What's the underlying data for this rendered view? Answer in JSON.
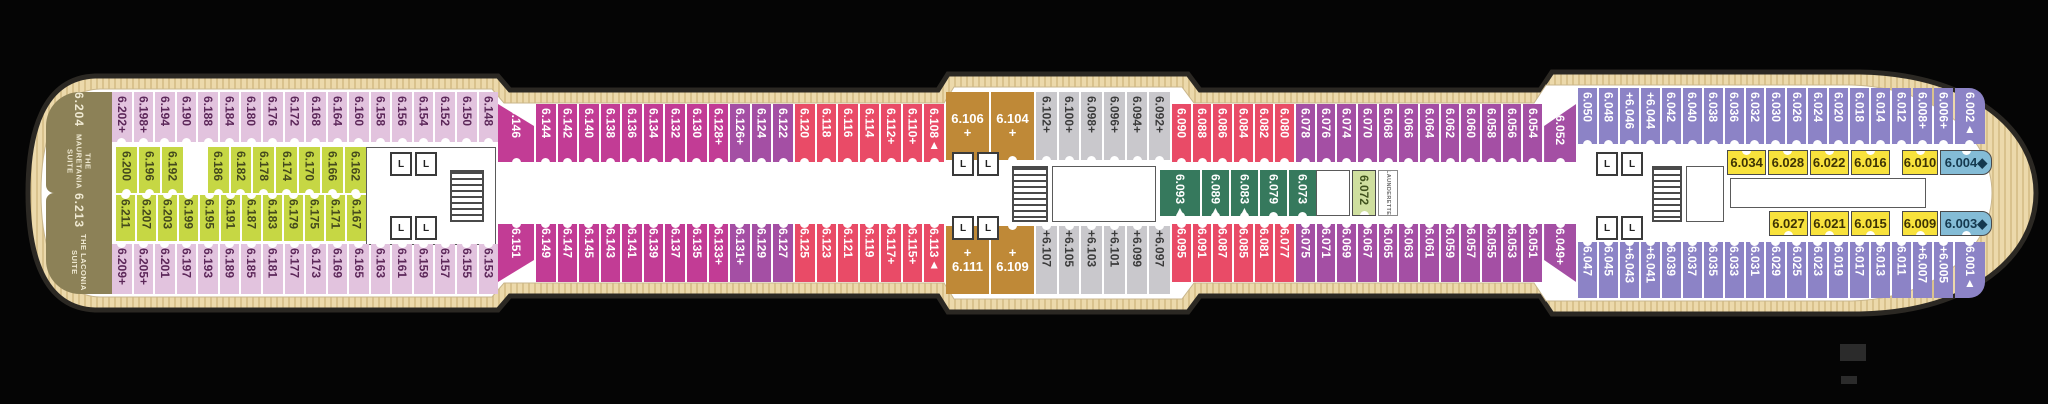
{
  "deck_plan": {
    "background": "#050505",
    "palette": {
      "lilac": "#e2c3de",
      "lime": "#c6d744",
      "magenta": "#c23c95",
      "purple": "#a44fa4",
      "red": "#e94b67",
      "gray": "#c9c8cc",
      "brown": "#bf8937",
      "teal": "#36795d",
      "palegreen": "#cfdf9f",
      "periwinkle": "#8c83c6",
      "yellow": "#f8e23c",
      "blue": "#84bcd6",
      "suite_olive": "#8c8157",
      "deck_wood": "#ecd9ab",
      "deck_stripe": "#d9c28d",
      "hull_outline": "#2b2823",
      "corridor": "#ffffff"
    },
    "symbols": {
      "plus": "+",
      "triangle": "▲",
      "diamond": "◆"
    },
    "suites": [
      {
        "number": "6.204",
        "name": "THE MAURETANIA SUITE",
        "x": 46,
        "y": 92,
        "w": 66,
        "h": 101,
        "radius": "34px 0 0 8px"
      },
      {
        "number": "6.213",
        "name": "THE LACONIA SUITE",
        "x": 46,
        "y": 193,
        "w": 66,
        "h": 101,
        "radius": "8px 0 0 34px"
      }
    ],
    "rows": [
      {
        "id": "aft-top-outer",
        "x": 112,
        "y": 92,
        "w": 386,
        "h": 50,
        "orient": "v",
        "color": "lilac",
        "notch": "b",
        "cells": [
          "6.202+",
          "6.198+",
          "6.194",
          "6.190",
          "6.188",
          "6.184",
          "6.180",
          "6.176",
          "6.172",
          "6.168",
          "6.164",
          "6.160",
          "6.158",
          "6.156",
          "6.154",
          "6.152",
          "6.150",
          "6.148"
        ]
      },
      {
        "id": "aft-top-inner",
        "x": 116,
        "y": 147,
        "w": 250,
        "h": 46,
        "orient": "v",
        "color": "lime",
        "notch": "b",
        "cells": [
          "6.200",
          "6.196",
          "6.192",
          null,
          "6.186",
          "6.182",
          "6.178",
          "6.174",
          "6.170",
          "6.166",
          "6.162"
        ]
      },
      {
        "id": "aft-bottom-inner",
        "x": 116,
        "y": 195,
        "w": 250,
        "h": 46,
        "orient": "v",
        "color": "lime",
        "notch": "t",
        "cells": [
          "6.211",
          "6.207",
          "6.203",
          "6.199",
          "6.195",
          "6.191",
          "6.187",
          "6.183",
          "6.179",
          "6.175",
          "6.171",
          "6.167"
        ]
      },
      {
        "id": "aft-bottom-outer",
        "x": 112,
        "y": 244,
        "w": 386,
        "h": 50,
        "orient": "v",
        "color": "lilac",
        "notch": "t",
        "cells": [
          "6.209+",
          "6.205+",
          "6.201",
          "6.197",
          "6.193",
          "6.189",
          "6.185",
          "6.181",
          "6.177",
          "6.173",
          "6.169",
          "6.165",
          "6.163",
          "6.161",
          "6.159",
          "6.157",
          "6.155",
          "6.153"
        ]
      },
      {
        "id": "waist-top",
        "x": 498,
        "y": 104,
        "w": 446,
        "h": 58,
        "orient": "v",
        "color": "magenta",
        "notch": "b",
        "cells": [
          {
            "label": "6.146",
            "w": 36,
            "shape": "clip-dr"
          },
          "6.144",
          "6.142",
          "6.140",
          "6.138",
          "6.136",
          "6.134",
          "6.132",
          "6.130",
          "6.128+",
          {
            "label": "6.126+",
            "color": "purple"
          },
          {
            "label": "6.124",
            "color": "purple"
          },
          {
            "label": "6.122",
            "color": "purple"
          },
          {
            "label": "6.120",
            "color": "red"
          },
          {
            "label": "6.118",
            "color": "red"
          },
          {
            "label": "6.116",
            "color": "red"
          },
          {
            "label": "6.114",
            "color": "red"
          },
          {
            "label": "6.112+",
            "color": "red"
          },
          {
            "label": "6.110+",
            "color": "red"
          },
          {
            "label": "6.108▲",
            "color": "red"
          }
        ]
      },
      {
        "id": "waist-bottom",
        "x": 498,
        "y": 224,
        "w": 446,
        "h": 58,
        "orient": "v",
        "color": "magenta",
        "notch": "t",
        "cells": [
          {
            "label": "6.151",
            "w": 36,
            "shape": "clip-ur"
          },
          "6.149",
          "6.147",
          "6.145",
          "6.143",
          "6.141",
          "6.139",
          "6.137",
          "6.135",
          "6.133+",
          {
            "label": "6.131+",
            "color": "purple"
          },
          {
            "label": "6.129",
            "color": "purple"
          },
          {
            "label": "6.127",
            "color": "purple"
          },
          {
            "label": "6.125",
            "color": "red"
          },
          {
            "label": "6.123",
            "color": "red"
          },
          {
            "label": "6.121",
            "color": "red"
          },
          {
            "label": "6.119",
            "color": "red"
          },
          {
            "label": "6.117+",
            "color": "red"
          },
          {
            "label": "6.115+",
            "color": "red"
          },
          {
            "label": "6.113▲",
            "color": "red"
          }
        ]
      },
      {
        "id": "mid-top-brown",
        "x": 946,
        "y": 92,
        "w": 88,
        "h": 68,
        "orient": "h",
        "color": "brown",
        "notch": "b",
        "cells": [
          "6.106\n+",
          "6.104\n+"
        ]
      },
      {
        "id": "mid-bottom-brown",
        "x": 946,
        "y": 226,
        "w": 88,
        "h": 68,
        "orient": "h",
        "color": "brown",
        "notch": "t",
        "cells": [
          "+\n6.111",
          "+\n6.109"
        ]
      },
      {
        "id": "mid-top-gray",
        "x": 1036,
        "y": 92,
        "w": 134,
        "h": 68,
        "orient": "v",
        "color": "gray",
        "notch": "b",
        "cells": [
          "6.102+",
          "6.100+",
          "6.098+",
          "6.096+",
          "6.094+",
          "6.092+"
        ]
      },
      {
        "id": "mid-bottom-gray",
        "x": 1036,
        "y": 226,
        "w": 134,
        "h": 68,
        "orient": "v",
        "color": "gray",
        "notch": "t",
        "cells": [
          "+6.107",
          "+6.105",
          "+6.103",
          "+6.101",
          "+6.099",
          "+6.097"
        ]
      },
      {
        "id": "mid-top-run",
        "x": 1172,
        "y": 104,
        "w": 404,
        "h": 58,
        "orient": "v",
        "color": "red",
        "notch": "b",
        "cells": [
          "6.090",
          "6.088",
          "6.086",
          "6.084",
          "6.082",
          "6.080",
          {
            "label": "6.078",
            "color": "purple"
          },
          {
            "label": "6.076",
            "color": "purple"
          },
          {
            "label": "6.074",
            "color": "purple"
          },
          {
            "label": "6.070",
            "color": "purple"
          },
          {
            "label": "6.068",
            "color": "purple"
          },
          {
            "label": "6.066",
            "color": "purple"
          },
          {
            "label": "6.064",
            "color": "purple"
          },
          {
            "label": "6.062",
            "color": "purple"
          },
          {
            "label": "6.060",
            "color": "purple"
          },
          {
            "label": "6.058",
            "color": "purple"
          },
          {
            "label": "6.056",
            "color": "purple"
          },
          {
            "label": "6.054",
            "color": "purple"
          },
          {
            "label": "+6.052",
            "color": "purple",
            "w": 32,
            "shape": "clip-tr"
          }
        ]
      },
      {
        "id": "mid-bottom-run",
        "x": 1172,
        "y": 224,
        "w": 404,
        "h": 58,
        "orient": "v",
        "color": "red",
        "notch": "t",
        "cells": [
          "6.095",
          "6.091",
          "6.087",
          "6.085",
          "6.081",
          "6.077",
          {
            "label": "6.075",
            "color": "purple"
          },
          {
            "label": "6.071",
            "color": "purple"
          },
          {
            "label": "6.069",
            "color": "purple"
          },
          {
            "label": "6.067",
            "color": "purple"
          },
          {
            "label": "6.065",
            "color": "purple"
          },
          {
            "label": "6.063",
            "color": "purple"
          },
          {
            "label": "6.061",
            "color": "purple"
          },
          {
            "label": "6.059",
            "color": "purple"
          },
          {
            "label": "6.057",
            "color": "purple"
          },
          {
            "label": "6.055",
            "color": "purple"
          },
          {
            "label": "6.053",
            "color": "purple"
          },
          {
            "label": "6.051",
            "color": "purple"
          },
          {
            "label": "6.049+",
            "color": "purple",
            "w": 32,
            "shape": "clip-br"
          }
        ]
      },
      {
        "id": "mid-inside-teal",
        "x": 1160,
        "y": 170,
        "w": 156,
        "h": 46,
        "orient": "v",
        "color": "teal",
        "notch": "b",
        "cells": [
          {
            "label": "6.093▲",
            "w": 40
          },
          "6.089▲",
          "6.083▲",
          "6.079",
          "6.073"
        ]
      },
      {
        "id": "cabin-6072",
        "x": 1352,
        "y": 170,
        "w": 24,
        "h": 46,
        "orient": "v",
        "color": "palegreen",
        "notch": "b",
        "bordered": true,
        "cells": [
          "6.072"
        ]
      },
      {
        "id": "fwd-top-outer",
        "x": 1578,
        "y": 88,
        "w": 407,
        "h": 56,
        "orient": "v",
        "color": "periwinkle",
        "notch": "b",
        "cells": [
          "6.050",
          "6.048",
          "+6.046",
          "+6.044",
          "6.042",
          "6.040",
          "6.038",
          "6.036",
          "6.032",
          "6.030",
          "6.026",
          "6.024",
          "6.020",
          "6.018",
          "6.014",
          "6.012",
          "6.008+",
          "6.006+",
          {
            "label": "6.002▲",
            "w": 30,
            "shape": "round-tr"
          }
        ]
      },
      {
        "id": "fwd-bottom-outer",
        "x": 1578,
        "y": 242,
        "w": 407,
        "h": 56,
        "orient": "v",
        "color": "periwinkle",
        "notch": "t",
        "cells": [
          "6.047",
          "6.045",
          "+6.043",
          "+6.041",
          "6.039",
          "6.037",
          "6.035",
          "6.033",
          "6.031",
          "6.029",
          "6.025",
          "6.023",
          "6.019",
          "6.017",
          "6.013",
          "6.011",
          "+6.007",
          "+6.005",
          {
            "label": "6.001▲",
            "w": 30,
            "shape": "round-br"
          }
        ]
      },
      {
        "id": "fwd-top-mid-a",
        "x": 1727,
        "y": 150,
        "w": 163,
        "h": 25,
        "orient": "h",
        "color": "yellow",
        "notch": "t",
        "bordered": true,
        "cells": [
          "6.034",
          "6.028",
          "6.022",
          "6.016"
        ]
      },
      {
        "id": "fwd-top-mid-b",
        "x": 1902,
        "y": 150,
        "w": 90,
        "h": 25,
        "orient": "h",
        "color": "yellow",
        "notch": "t",
        "bordered": true,
        "cells": [
          {
            "label": "6.010",
            "w": 36
          },
          {
            "label": "6.004◆",
            "color": "blue",
            "shape": "round-r"
          }
        ]
      },
      {
        "id": "fwd-bottom-mid-a",
        "x": 1769,
        "y": 211,
        "w": 121,
        "h": 25,
        "orient": "h",
        "color": "yellow",
        "notch": "b",
        "bordered": true,
        "cells": [
          "6.027",
          "6.021",
          "6.015"
        ]
      },
      {
        "id": "fwd-bottom-mid-b",
        "x": 1902,
        "y": 211,
        "w": 90,
        "h": 25,
        "orient": "h",
        "color": "yellow",
        "notch": "b",
        "bordered": true,
        "cells": [
          {
            "label": "6.009",
            "w": 36
          },
          {
            "label": "6.003◆",
            "color": "blue",
            "shape": "round-r"
          }
        ]
      }
    ],
    "launderette": {
      "label": "LAUNDERETTE",
      "x": 1378,
      "y": 170,
      "w": 20,
      "h": 46
    },
    "lifts": {
      "label": "L",
      "positions": [
        [
          390,
          152
        ],
        [
          415,
          152
        ],
        [
          390,
          216
        ],
        [
          415,
          216
        ],
        [
          952,
          152
        ],
        [
          977,
          152
        ],
        [
          952,
          216
        ],
        [
          977,
          216
        ],
        [
          1596,
          152
        ],
        [
          1621,
          152
        ],
        [
          1596,
          216
        ],
        [
          1621,
          216
        ]
      ]
    },
    "stairs": [
      [
        450,
        170,
        34,
        52
      ],
      [
        1012,
        166,
        36,
        56
      ],
      [
        1652,
        166,
        30,
        56
      ]
    ],
    "rooms": [
      [
        366,
        147,
        130,
        98
      ],
      [
        1052,
        166,
        104,
        56
      ],
      [
        1316,
        170,
        34,
        46
      ],
      [
        1686,
        166,
        38,
        56
      ],
      [
        1730,
        178,
        196,
        30
      ]
    ],
    "marks": [
      {
        "x": 1840,
        "y": 344,
        "w": 26,
        "h": 17,
        "color": "#2b2b2b"
      },
      {
        "x": 1841,
        "y": 376,
        "w": 16,
        "h": 8,
        "color": "#2b2b2b"
      }
    ]
  }
}
